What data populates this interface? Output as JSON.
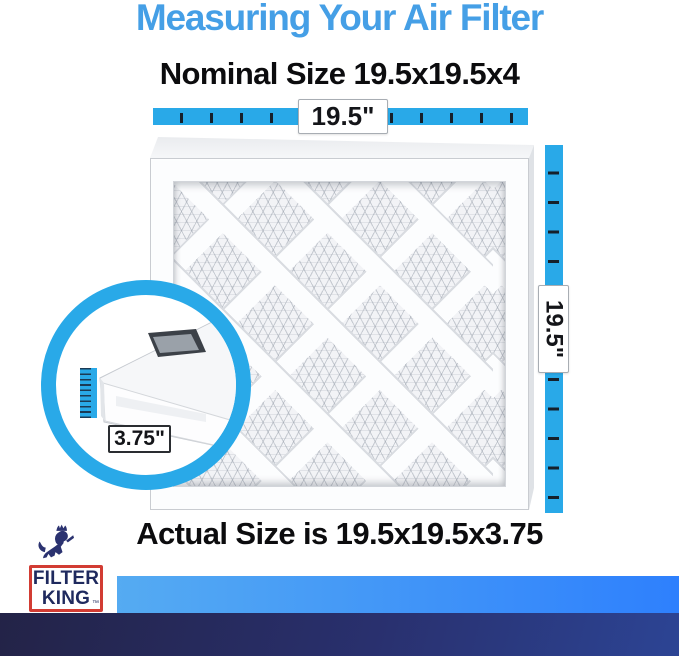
{
  "title": "Measuring Your Air Filter",
  "nominal_size_heading": "Nominal Size 19.5x19.5x4",
  "actual_size_heading": "Actual Size is 19.5x19.5x3.75",
  "measurements": {
    "width": "19.5\"",
    "height": "19.5\"",
    "depth": "3.75\""
  },
  "logo": {
    "line1": "FILTER",
    "line2": "KING",
    "trademark": "™"
  },
  "colors": {
    "title_blue": "#459fe6",
    "ruler_blue": "#29a9e8",
    "tick_dark": "#15202b",
    "stripe_gradient": [
      "#55abf2",
      "#2e80fd"
    ],
    "footer_navy_gradient": [
      "#232347",
      "#2c4494"
    ],
    "logo_navy": "#1f2a5e",
    "logo_red": "#d23c33",
    "heading_black": "#0c0c0e"
  }
}
